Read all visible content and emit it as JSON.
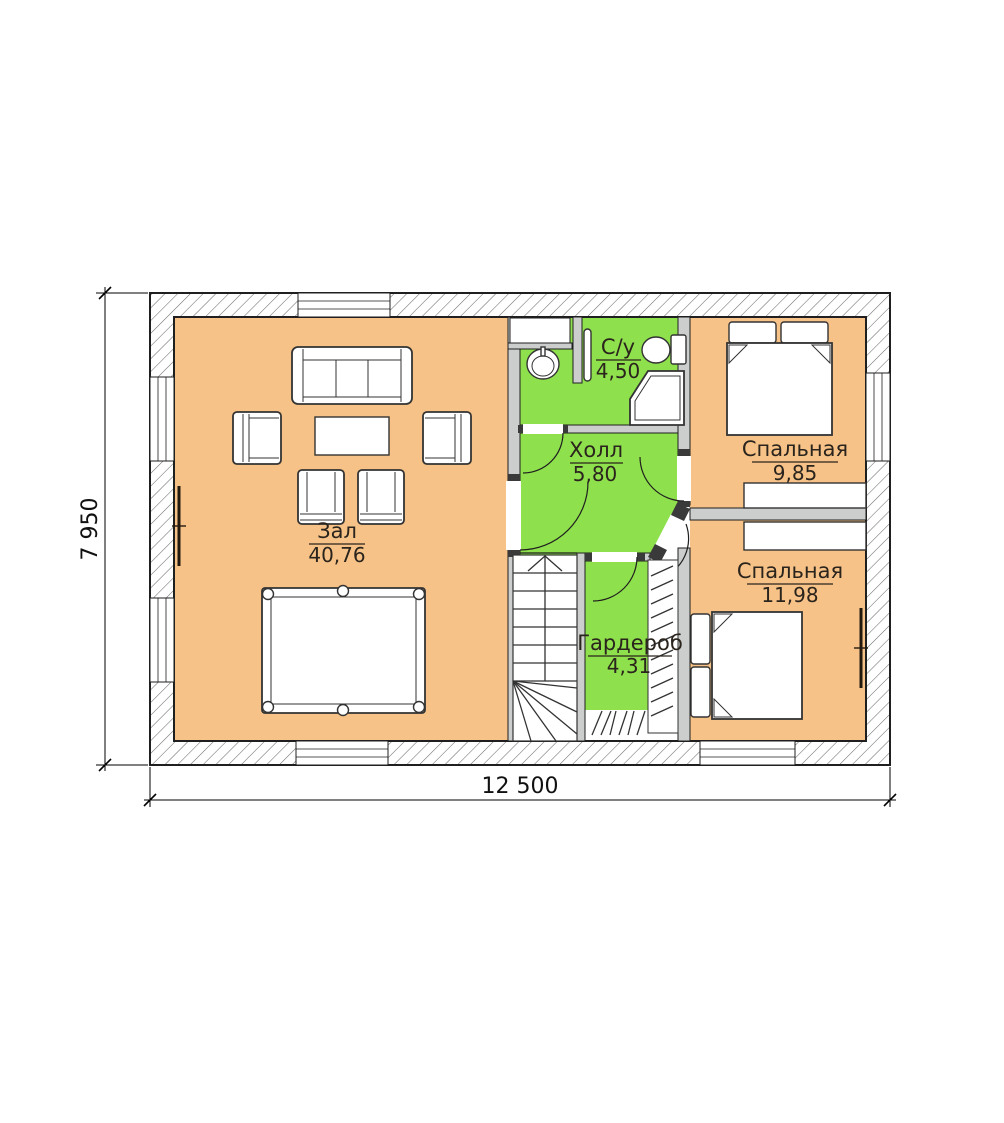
{
  "plan": {
    "rooms": [
      {
        "id": "zal",
        "name": "Зал",
        "area": "40,76"
      },
      {
        "id": "holl",
        "name": "Холл",
        "area": "5,80"
      },
      {
        "id": "su",
        "name": "С/у",
        "area": "4,50"
      },
      {
        "id": "bedroom-top",
        "name": "Спальная",
        "area": "9,85"
      },
      {
        "id": "bedroom-bottom",
        "name": "Спальная",
        "area": "11,98"
      },
      {
        "id": "garderob",
        "name": "Гардероб",
        "area": "4,31"
      }
    ],
    "dimensions": {
      "overall_width": "12 500",
      "overall_height": "7 950"
    }
  },
  "colors": {
    "floor_warm": "#F6C287",
    "floor_green": "#8FE04D",
    "partition": "#CBCECC",
    "hatch": "#6E6E6E",
    "wall_line": "#1F1F1F",
    "furniture_line": "#333333",
    "label_text": "#2A241D",
    "dim_text": "#111111"
  }
}
